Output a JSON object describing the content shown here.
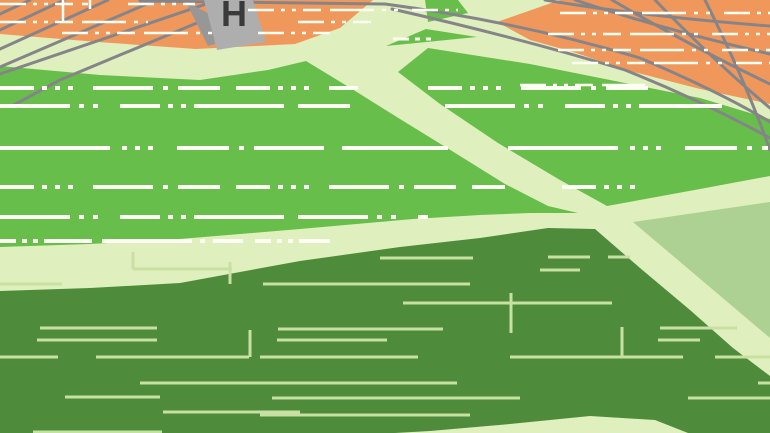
{
  "map": {
    "building_label": "H",
    "colors": {
      "pale": "#E0EFBE",
      "orange": "#F0985C",
      "green": "#68BE4B",
      "darkgreen": "#4E8C3B",
      "sage": "#ACD192",
      "rail": "#858589",
      "building": "#AEAEAE",
      "shadow": "#979797",
      "label": "#3A3A3A",
      "white": "#FDFFF4",
      "fieldline": "#C8E1A3"
    },
    "dash_patterns": {
      "A": "34 8 5 8 5 8 5 20 60 10 5 10 42 16",
      "B": "70 9 5 9 5 22 40 8 5 8 5 8 90 14",
      "C": "16 6 5 6 5 6 48 10 90 8 5 8 30 12",
      "D": "110 12 5 8 5 8 5 24 52 10 5 10 70 18",
      "E": "26 7 4 7 4 7 18 9 44 8 4 8 4 14"
    },
    "green_dash_rows": [
      {
        "y": 39,
        "w": 3,
        "pattern": "C",
        "segs": [
          [
            393,
            437
          ]
        ]
      },
      {
        "y": 88,
        "w": 4,
        "pattern": "A",
        "segs": [
          [
            0,
            358
          ],
          [
            428,
            655
          ]
        ]
      },
      {
        "y": 106,
        "w": 4,
        "pattern": "B",
        "segs": [
          [
            0,
            350
          ],
          [
            445,
            722
          ]
        ]
      },
      {
        "y": 148,
        "w": 4,
        "pattern": "D",
        "segs": [
          [
            0,
            448
          ],
          [
            508,
            768
          ]
        ]
      },
      {
        "y": 187,
        "w": 4,
        "pattern": "A",
        "segs": [
          [
            0,
            505
          ],
          [
            562,
            640
          ]
        ]
      },
      {
        "y": 217,
        "w": 4,
        "pattern": "B",
        "segs": [
          [
            0,
            428
          ]
        ]
      },
      {
        "y": 241,
        "w": 4,
        "pattern": "C",
        "segs": [
          [
            0,
            330
          ]
        ]
      }
    ],
    "orange_dash_rows": [
      {
        "y": 4,
        "w": 2.5,
        "pattern": "E",
        "segs": [
          [
            0,
            88
          ],
          [
            128,
            195
          ]
        ]
      },
      {
        "y": 10,
        "w": 2.5,
        "pattern": "E",
        "segs": [
          [
            248,
            458
          ]
        ]
      },
      {
        "y": 22,
        "w": 2.5,
        "pattern": "E",
        "segs": [
          [
            0,
            148
          ],
          [
            298,
            372
          ]
        ]
      },
      {
        "y": 33,
        "w": 2.5,
        "pattern": "E",
        "segs": [
          [
            62,
            212
          ],
          [
            258,
            330
          ]
        ]
      },
      {
        "y": 13,
        "w": 2.5,
        "pattern": "E",
        "segs": [
          [
            560,
            770
          ]
        ]
      },
      {
        "y": 34,
        "w": 2.5,
        "pattern": "E",
        "segs": [
          [
            548,
            770
          ]
        ]
      },
      {
        "y": 50,
        "w": 2.5,
        "pattern": "E",
        "segs": [
          [
            558,
            770
          ]
        ]
      },
      {
        "y": 63,
        "w": 2.5,
        "pattern": "E",
        "segs": [
          [
            572,
            770
          ]
        ]
      },
      {
        "y": 85,
        "w": 2.5,
        "pattern": "E",
        "segs": [
          [
            520,
            645
          ]
        ]
      }
    ],
    "white_ticks": [
      [
        63,
        0,
        21
      ],
      [
        90,
        0,
        9
      ]
    ],
    "field_lines": [
      {
        "y": 257,
        "segs": [
          [
            548,
            590
          ],
          [
            608,
            630
          ]
        ]
      },
      {
        "y": 258,
        "segs": [
          [
            380,
            473
          ]
        ]
      },
      {
        "y": 269,
        "segs": [
          [
            133,
            232
          ]
        ]
      },
      {
        "y": 270,
        "segs": [
          [
            540,
            580
          ]
        ]
      },
      {
        "y": 284,
        "segs": [
          [
            0,
            62
          ],
          [
            263,
            470
          ]
        ]
      },
      {
        "y": 303,
        "segs": [
          [
            403,
            612
          ]
        ]
      },
      {
        "y": 328,
        "segs": [
          [
            40,
            157
          ],
          [
            660,
            737
          ]
        ]
      },
      {
        "y": 329,
        "segs": [
          [
            278,
            443
          ]
        ]
      },
      {
        "y": 340,
        "segs": [
          [
            37,
            157
          ],
          [
            277,
            387
          ],
          [
            658,
            700
          ]
        ]
      },
      {
        "y": 357,
        "segs": [
          [
            0,
            58
          ],
          [
            96,
            249
          ],
          [
            260,
            418
          ],
          [
            510,
            683
          ],
          [
            715,
            770
          ]
        ]
      },
      {
        "y": 383,
        "segs": [
          [
            140,
            457
          ],
          [
            758,
            770
          ]
        ]
      },
      {
        "y": 397,
        "segs": [
          [
            65,
            160
          ]
        ]
      },
      {
        "y": 398,
        "segs": [
          [
            272,
            520
          ],
          [
            688,
            770
          ]
        ]
      },
      {
        "y": 412,
        "segs": [
          [
            163,
            300
          ]
        ]
      },
      {
        "y": 415,
        "segs": [
          [
            260,
            470
          ]
        ]
      },
      {
        "y": 432,
        "segs": [
          [
            33,
            162
          ]
        ]
      }
    ],
    "field_ticks": [
      [
        133,
        252,
        269
      ],
      [
        230,
        262,
        284
      ],
      [
        250,
        330,
        357
      ],
      [
        622,
        327,
        358
      ],
      [
        511,
        293,
        333
      ]
    ],
    "rails_left": [
      "M30,0 L0,14",
      "M64,0 L0,30",
      "M108,0 L0,49",
      "M156,0 L0,67",
      "M218,0 L0,74",
      "M252,0 L60,80 L12,106"
    ],
    "rails_right": [
      "M545,0 Q640,16 770,26",
      "M575,0 Q665,30 770,54",
      "M612,0 Q690,46 770,84",
      "M655,0 Q715,62 770,108",
      "M705,0 Q745,80 770,150",
      "M140,1 L385,4 Q520,22 640,58 Q720,92 770,122",
      "M392,9 Q520,38 625,70 Q700,100 770,138"
    ]
  }
}
